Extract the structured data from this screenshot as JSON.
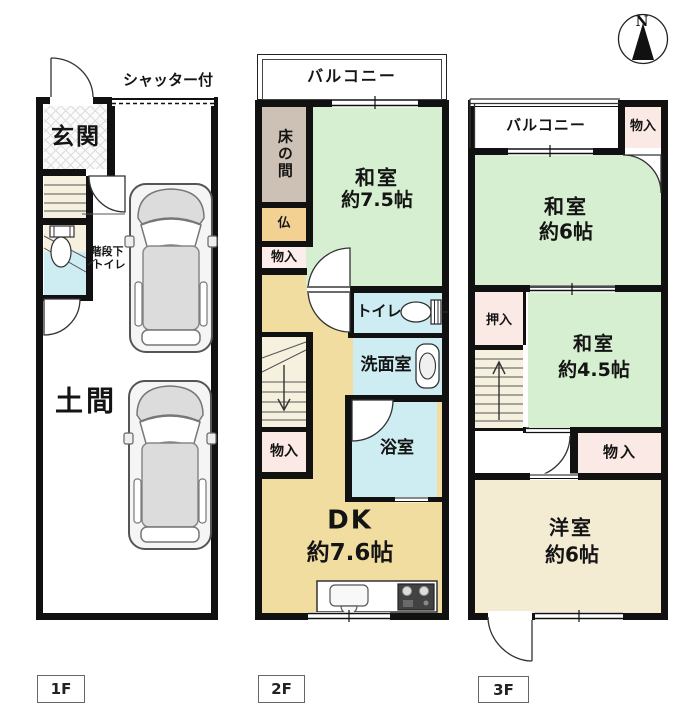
{
  "compass": {
    "north": "N"
  },
  "floor1": {
    "label": "1F",
    "shutter": "シャッター付",
    "genkan": "玄関",
    "under_stairs_toilet": [
      "階段下",
      "トイレ"
    ],
    "doma": "土間"
  },
  "floor2": {
    "label": "2F",
    "balcony": "バルコニー",
    "tokonoma": "床の間",
    "washitsu": "和室",
    "washitsu_size": "約7.5帖",
    "butsudan": "仏",
    "storage_upper": "物入",
    "toilet": "トイレ",
    "washroom": "洗面室",
    "bathroom": "浴室",
    "storage_lower": "物入",
    "dk": "DK",
    "dk_size": "約7.6帖"
  },
  "floor3": {
    "label": "3F",
    "balcony": "バルコニー",
    "storage_top": "物入",
    "washitsu6": "和室",
    "washitsu6_size": "約6帖",
    "oshiire": "押入",
    "washitsu45": "和室",
    "washitsu45_size": "約4.5帖",
    "storage_mid": "物入",
    "youshitsu": "洋室",
    "youshitsu_size": "約6帖"
  },
  "colors": {
    "wall": "#111111",
    "tatami_green": "#d6efd0",
    "water_blue": "#cdedf2",
    "dk_tan": "#f2dda0",
    "western_cream": "#f3ecd3",
    "closet_pink": "#fbe9e5",
    "closet_white_pink": "#fdeeec",
    "tokonoma_brown": "#cdc0b5",
    "butsudan_orange": "#f2d193",
    "stair_beige": "#f6f1de"
  }
}
